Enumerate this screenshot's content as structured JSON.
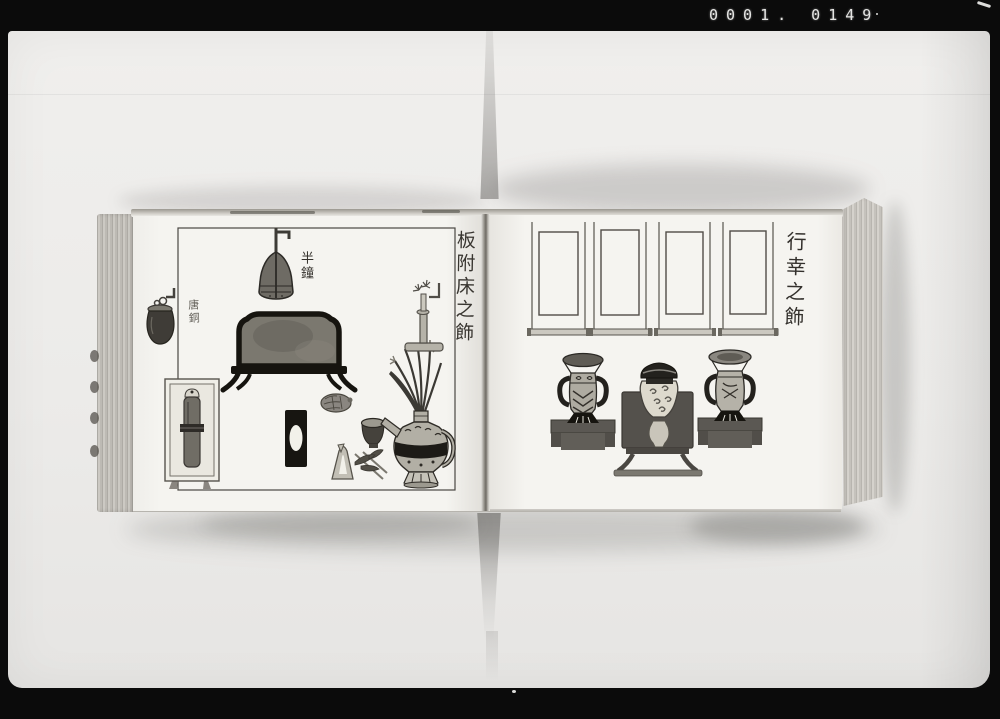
{
  "photo": {
    "film_code": "0001. 0149"
  },
  "book": {
    "left_page": {
      "caption": "板附床之飾",
      "labels": {
        "bell": "半鐘",
        "jar": "唐銅"
      }
    },
    "right_page": {
      "caption": "行幸之飾"
    }
  },
  "colors": {
    "film_background": "#0b0b0b",
    "backdrop": "#ecebe9",
    "page": "#f5f4f0",
    "ink": "#2e2b27"
  }
}
